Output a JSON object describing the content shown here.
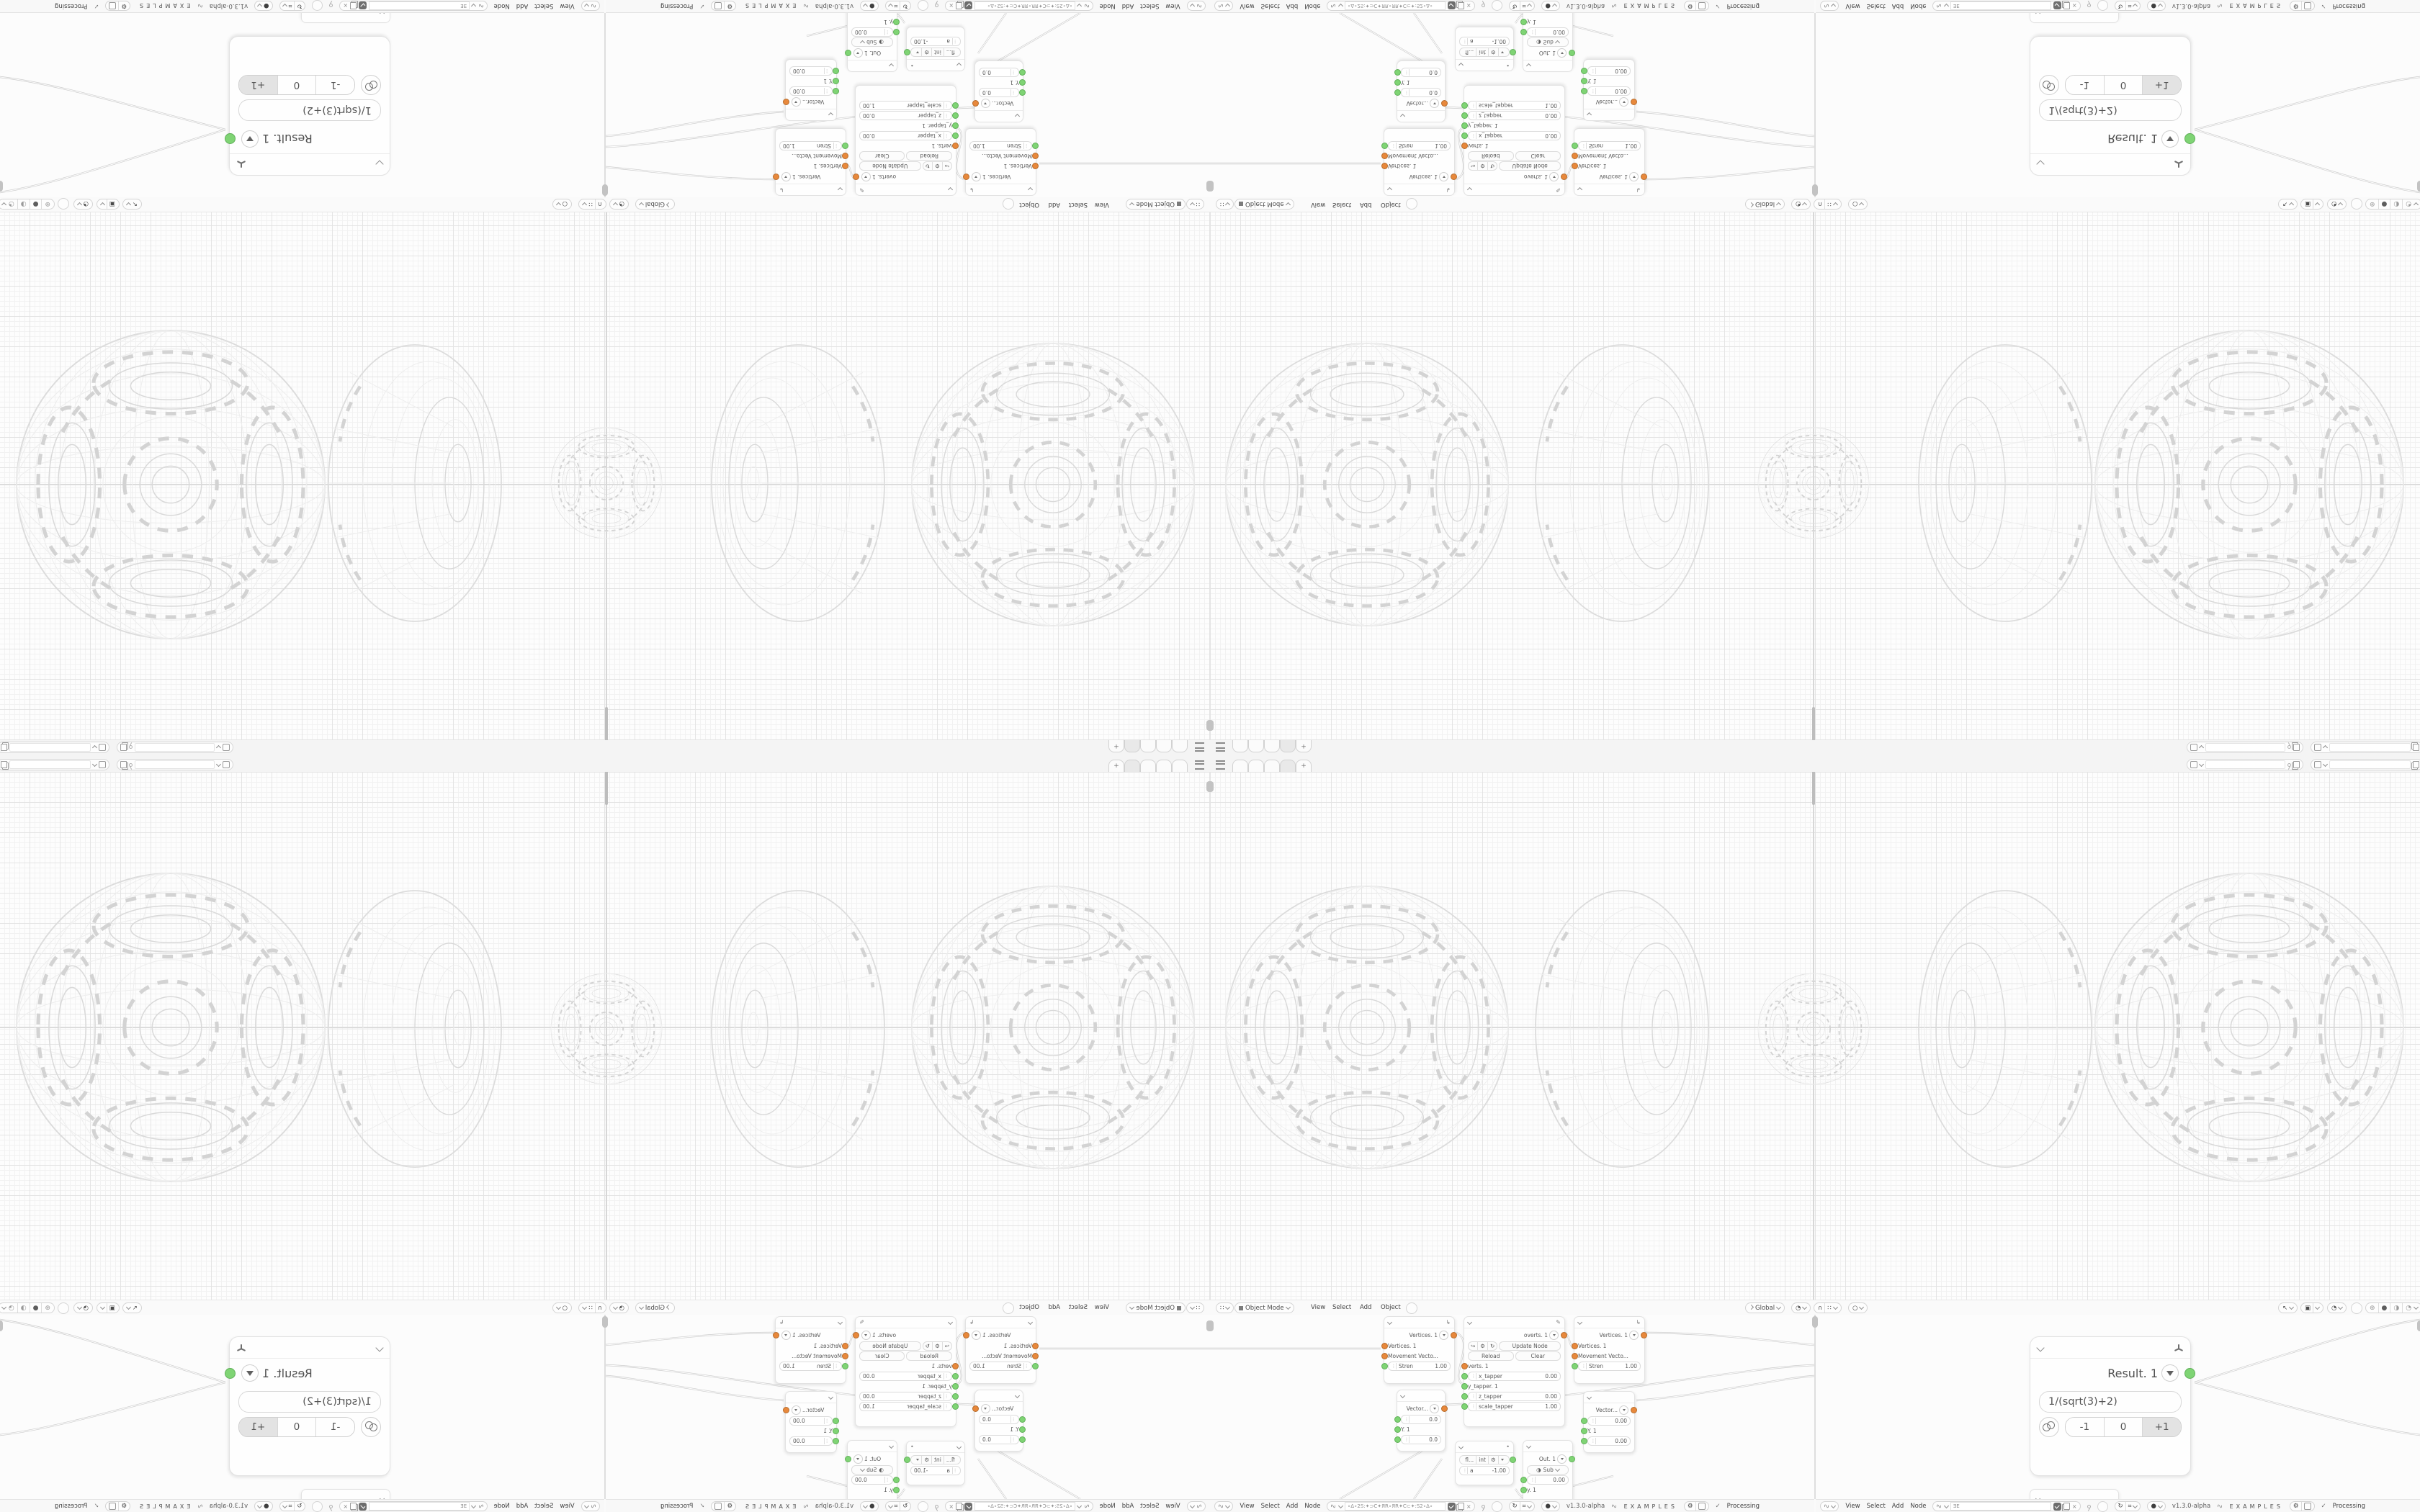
{
  "app": {
    "version_label": "v1.3.0-alpha",
    "examples_label": "EXAMPLES",
    "processing_label": "Processing"
  },
  "icons": {
    "plus": "+",
    "close": "×",
    "check": "✓",
    "editor_grid": "∷",
    "magnet": "∩",
    "proportional": "○",
    "gizmo_pointer": "↖",
    "overlays": "▣",
    "xray": "◔",
    "shade_wire": "⊕",
    "shade_solid": "●",
    "shade_material": "◑",
    "shade_rendered": "◔",
    "refresh": "↻",
    "hash": "⌗",
    "gear": "⚙",
    "logo_wave": "∿",
    "dot": "•",
    "globe": "◑"
  },
  "viewport_header": {
    "mode": "Object Mode",
    "menus": [
      "View",
      "Select",
      "Add",
      "Object"
    ],
    "orientation": "Global"
  },
  "node_editor": {
    "menus": [
      "View",
      "Select",
      "Add",
      "Node"
    ],
    "left_tree_name": "∘Δ∘2S:✦⊃C✦ЯR∘ЯR✦C⊂✦:S2∘Δ∘",
    "right_tree_name": "ƎE"
  },
  "nodes": {
    "move": {
      "title": "Vertices. 1",
      "input_vertices": "Vertices. 1",
      "input_movement": "Movement Vecto...",
      "strength_label": "Stren",
      "strength_value": "1.00"
    },
    "vector_a": {
      "title": "Vector...",
      "x_value": "0.0",
      "y_label": "Y. 1",
      "z_value": "0.0"
    },
    "vector_b": {
      "title": "Vector...",
      "x_value": "0.00",
      "y_label": "Y. 1",
      "z_value": "0.00"
    },
    "script": {
      "title": "overts. 1",
      "update_label": "Update Node",
      "reload_label": "Reload",
      "clear_label": "Clear",
      "verts_label": "verts. 1",
      "x_tapper_label": "x_tapper",
      "x_tapper_value": "0.00",
      "y_tapper_label": "y_tapper. 1",
      "z_tapper_label": "z_tapper",
      "z_tapper_value": "0.00",
      "scale_tapper_label": "scale_tapper",
      "scale_tapper_value": "1.00"
    },
    "number": {
      "float_label": "fl...",
      "int_label": "int",
      "a_label": "a",
      "a_value": "-1.00"
    },
    "out": {
      "title": "Out. 1",
      "op_label": "Sub",
      "value": "0.00",
      "y_label": "y. 1"
    },
    "result": {
      "title": "Result. 1",
      "formula": "1/(sqrt(3)+2)",
      "minus_label": "-1",
      "zero_label": "0",
      "plus_label": "+1"
    }
  }
}
